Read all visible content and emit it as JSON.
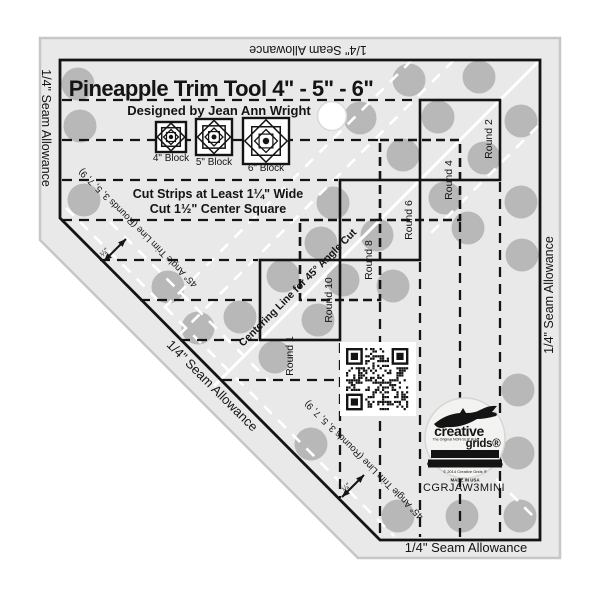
{
  "product": {
    "title": "Pineapple Trim Tool  4\" - 5\" - 6\"",
    "designer": "Designed by Jean Ann Wright",
    "sku": "CGRJAW3MINI"
  },
  "blocks": [
    "4\" Block",
    "5\" Block",
    "6\" Block"
  ],
  "instructions": {
    "line1": "Cut Strips at Least 1¼\" Wide",
    "line2": "Cut 1½\" Center Square"
  },
  "rounds": {
    "r1": "Round 1",
    "r2": "Round 2",
    "r4": "Round 4",
    "r6": "Round 6",
    "r8": "Round 8",
    "r10": "Round 10"
  },
  "guides": {
    "angle_trim": "45° Angle Trim Line (Rounds 3, 5, 7, 9)",
    "centering": "Centering Line for 45° Angle Cut",
    "quarter": "¼\""
  },
  "seam_allowance": "1/4\" Seam Allowance",
  "logo": {
    "brand_top": "creative",
    "brand_bottom": "grids®",
    "tagline": "The Original NON-SLIP Ruler",
    "uk": "UK - www.creativegrids.com",
    "usa": "USA - www.creativegridsusa.com",
    "copyright": "© 2014 Creative Grids ®",
    "made_in": "MADE IN USA"
  },
  "colors": {
    "acrylic": "#e9e9e9",
    "dot": "#b3b3b3",
    "ink": "#141414",
    "white_line": "#ffffff"
  }
}
